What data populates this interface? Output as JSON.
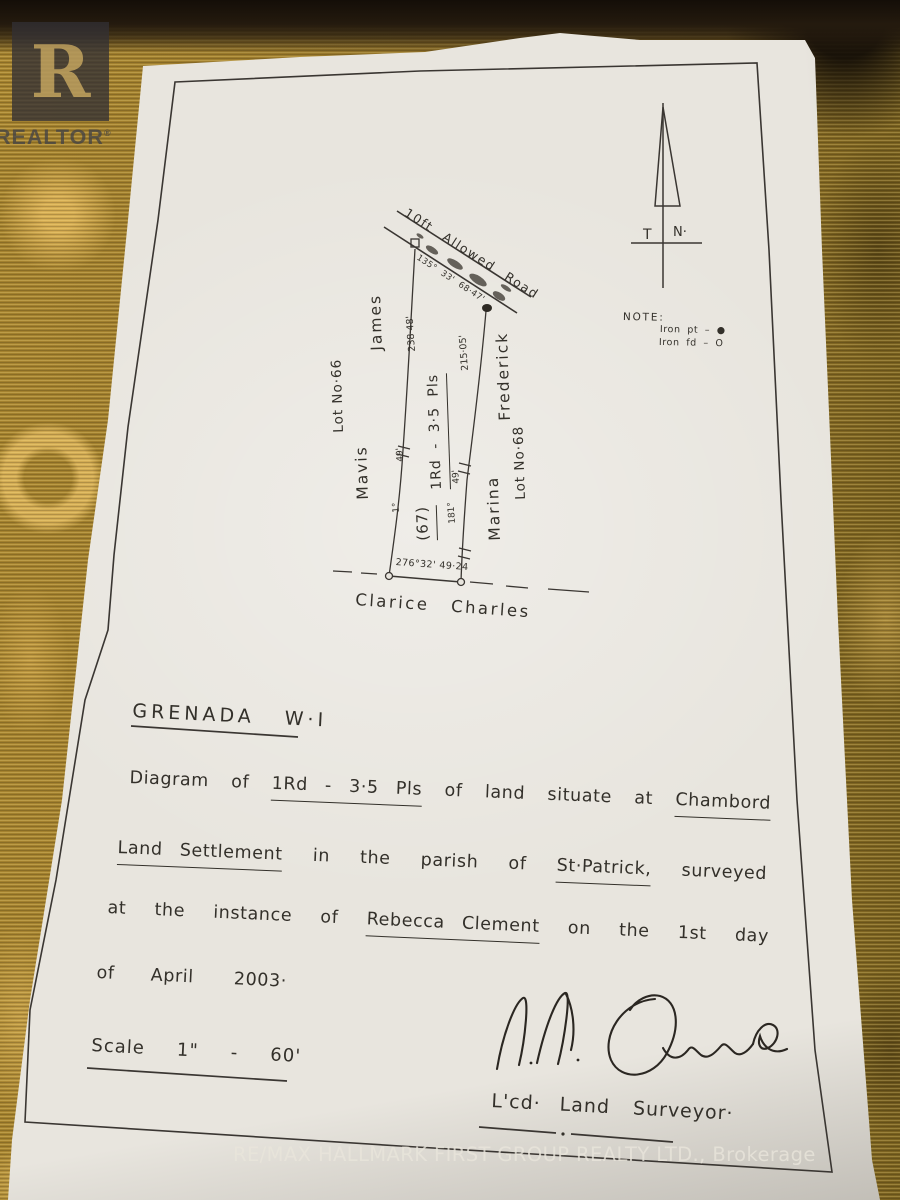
{
  "photo": {
    "realtor_watermark": {
      "letter": "R",
      "label": "REALTOR",
      "reg": "®"
    },
    "brokerage_watermark": "RE/MAX HALLMARK FIRST GROUP REALTY LTD., Brokerage"
  },
  "survey_plan": {
    "north_arrow": {
      "true_label": "T",
      "north_label": "N·"
    },
    "legend": {
      "title": "NOTE:",
      "iron_pt": "Iron pt – ●",
      "iron_fd": "Iron fd – O"
    },
    "road": {
      "name": "10ft Allowed Road",
      "bearing_distance": "135° 33' 68·47'"
    },
    "parcel": {
      "number": "(67)",
      "area": "1Rd - 3·5 Pls"
    },
    "boundaries": {
      "west_distance": "238·48'",
      "east_distance": "215·05'",
      "west_offset": "49'",
      "west_bearing": "1°",
      "east_offset": "49'",
      "east_bearing": "181°",
      "south_bearing_distance": "276°32' 49·24"
    },
    "adjoiners": {
      "west_first": "Mavis",
      "west_last": "James",
      "west_lot": "Lot No·66",
      "east_first": "Marina",
      "east_last": "Frederick",
      "east_lot": "Lot No·68",
      "south": "Clarice Charles"
    }
  },
  "description": {
    "title_left": "GRENADA",
    "title_right": "W·I",
    "line1": {
      "w1": "Diagram",
      "w2": "of",
      "w3": "1Rd - 3·5 Pls",
      "w4": "of",
      "w5": "land",
      "w6": "situate",
      "w7": "at",
      "w8": "Chambord"
    },
    "line2": {
      "w1": "Land Settlement",
      "w2": "in",
      "w3": "the",
      "w4": "parish",
      "w5": "of",
      "w6": "St·Patrick,",
      "w7": "surveyed"
    },
    "line3": {
      "w1": "at",
      "w2": "the",
      "w3": "instance",
      "w4": "of",
      "w5": "Rebecca Clement",
      "w6": "on",
      "w7": "the",
      "w8": "1st",
      "w9": "day"
    },
    "line4": {
      "w1": "of",
      "w2": "April",
      "w3": "2003·"
    },
    "scale_line": {
      "w1": "Scale",
      "w2": "1\"",
      "w3": "-",
      "w4": "60'"
    },
    "surveyor_line": {
      "w1": "L'cd·",
      "w2": "Land",
      "w3": "Surveyor·"
    }
  }
}
